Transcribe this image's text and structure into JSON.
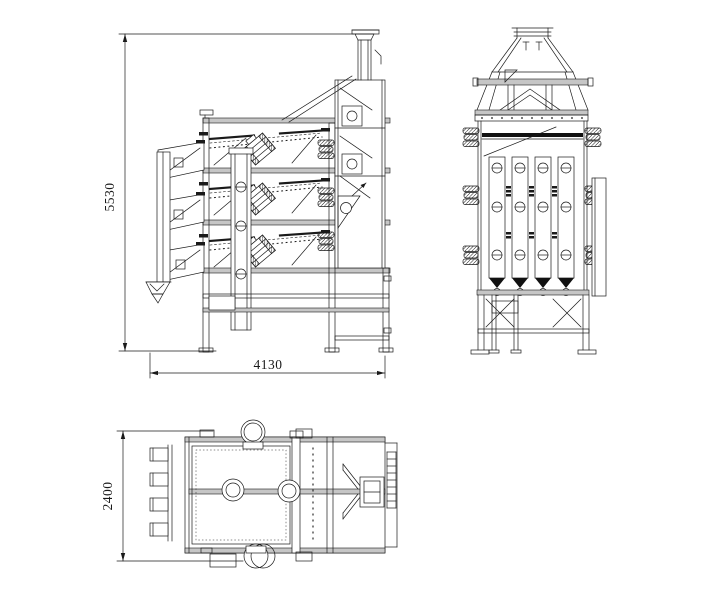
{
  "drawing": {
    "background": "#ffffff",
    "line_color": "#1a1a1a",
    "beam_fill": "#c6c6c6",
    "dimensions": {
      "front_height": "5530",
      "front_length": "4130",
      "plan_width": "2400"
    }
  }
}
